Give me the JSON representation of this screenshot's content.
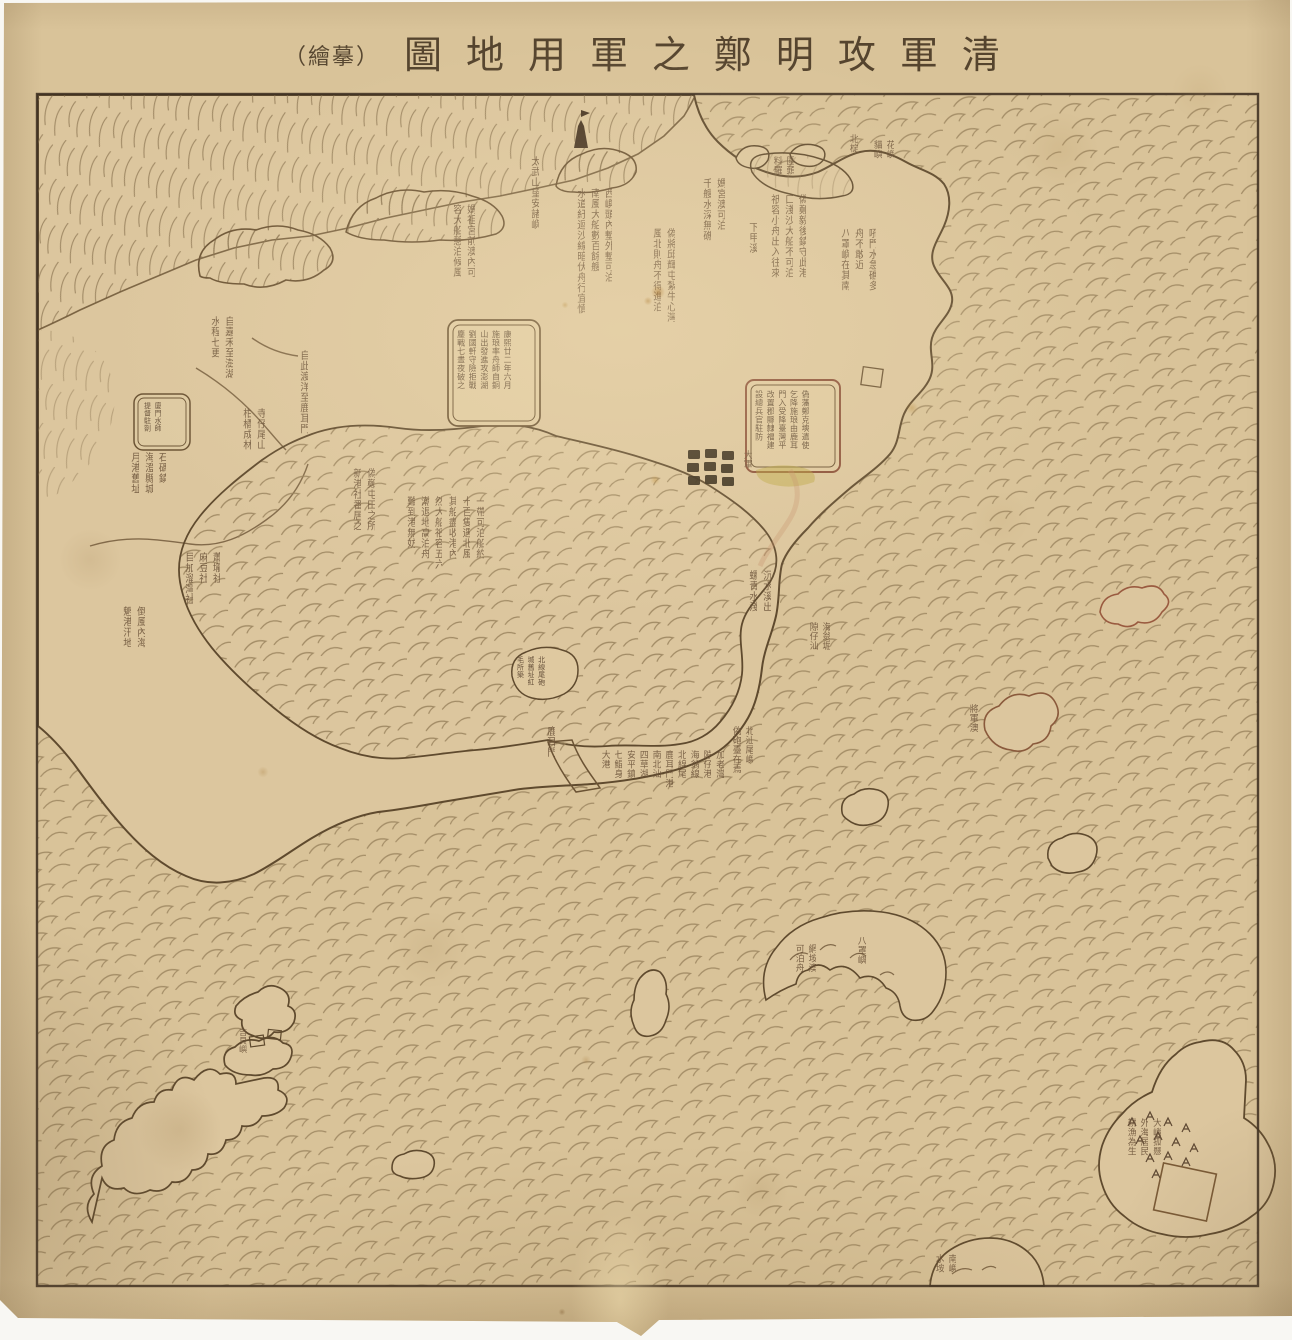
{
  "title": {
    "reading_rtl": "清軍攻明鄭之軍用地圖（摹繪）",
    "display_ltr": [
      "（繪摹）",
      "圖",
      "地",
      "用",
      "軍",
      "之",
      "鄭",
      "明",
      "攻",
      "軍",
      "清"
    ]
  },
  "palette": {
    "paper": "#d9c399",
    "land": "#dcc69e",
    "ink_outline": "#5f4a2e",
    "wave_ink": "#97805a",
    "text_ink": "#6a5138",
    "frame_ink": "#3f3122",
    "red_accent": "#9a5b40",
    "stain": "#a86f22",
    "unit_symbol": "#332818"
  },
  "transcription_fidelity": "approximate — handwritten brush annotations are largely illegible in source scan",
  "annotations": [
    {
      "name": "note-magong-anchorage",
      "x": 700,
      "y": 178,
      "h": 125,
      "fs": 10,
      "cols": [
        "媽宮澳可泊",
        "千艘水深無礁"
      ]
    },
    {
      "name": "note-xiajiaxi",
      "x": 746,
      "y": 222,
      "h": 64,
      "fs": 10,
      "cols": [
        "下甲溪"
      ]
    },
    {
      "name": "note-qiuhui-garrison",
      "x": 650,
      "y": 228,
      "h": 205,
      "fs": 10,
      "cols": [
        "偽將邱輝屯紮牛心灣",
        "風北則舟不得進泊"
      ]
    },
    {
      "name": "note-xiyu-passage",
      "x": 574,
      "y": 188,
      "h": 248,
      "fs": 10,
      "cols": [
        "西嶼頭內塹外塹可泊",
        "南風大船數百餘艘",
        "水道紆迴沙線暗伏舟行宜慎"
      ]
    },
    {
      "name": "note-taiwu-hills",
      "x": 528,
      "y": 156,
      "h": 140,
      "fs": 10,
      "cols": [
        "太武山望安諸嶼"
      ]
    },
    {
      "name": "note-mazu-harbor",
      "x": 450,
      "y": 204,
      "h": 192,
      "fs": 10,
      "cols": [
        "媽祖宮前澳內可",
        "容大船憩泊候風"
      ]
    },
    {
      "name": "note-houmen",
      "x": 838,
      "y": 228,
      "h": 196,
      "fs": 10,
      "cols": [
        "吼門水急礁多",
        "舟不敢近",
        "八罩嶼在其南"
      ]
    },
    {
      "name": "note-huayu",
      "x": 872,
      "y": 140,
      "h": 92,
      "fs": 9,
      "cols": [
        "花嶼",
        "貓嶼"
      ]
    },
    {
      "name": "note-east-coast",
      "x": 768,
      "y": 194,
      "h": 232,
      "fs": 10,
      "cols": [
        "偽鄭毅後鎮守此港",
        "口淺沙大船不可泊",
        "祇容小舟出入往來"
      ]
    },
    {
      "name": "note-water-route",
      "x": 208,
      "y": 316,
      "h": 92,
      "fs": 10,
      "cols": [
        "自嘉禾至澎湖",
        "水程七更"
      ]
    },
    {
      "name": "note-crossing",
      "x": 297,
      "y": 350,
      "h": 88,
      "fs": 10,
      "cols": [
        "自此渡洋至鹿耳門"
      ]
    },
    {
      "name": "note-temple-grove",
      "x": 240,
      "y": 408,
      "h": 122,
      "fs": 10,
      "cols": [
        "寺仔尾山",
        "柑橘成林"
      ]
    },
    {
      "name": "note-haicheng",
      "x": 128,
      "y": 452,
      "h": 128,
      "fs": 10,
      "cols": [
        "石碼鎮",
        "海澄縣城",
        "月港舊址"
      ]
    },
    {
      "name": "note-villages",
      "x": 182,
      "y": 552,
      "h": 152,
      "fs": 10,
      "cols": [
        "蕭壠社",
        "麻豆社",
        "目加溜灣社"
      ]
    },
    {
      "name": "note-daofeng-sea",
      "x": 120,
      "y": 606,
      "h": 116,
      "fs": 10,
      "cols": [
        "倒風內海",
        "魍港汛地"
      ]
    },
    {
      "name": "note-tuntian",
      "x": 350,
      "y": 468,
      "h": 182,
      "fs": 10,
      "cols": [
        "偽鄭屯田之所",
        "新港社番居之"
      ]
    },
    {
      "name": "note-anchorage-capacity",
      "x": 404,
      "y": 496,
      "h": 172,
      "fs": 10,
      "cols": [
        "一帶可泊船約",
        "十百隻遇北風",
        "其船盡收港內",
        "然大船祇容五六",
        "潮退地高泊舟",
        "難到港無妨"
      ]
    },
    {
      "name": "sandbar-port-names",
      "x": 600,
      "y": 750,
      "h": 80,
      "fs": 9,
      "cols": [
        "加老灣",
        "隙仔港",
        "海翁線",
        "北線尾",
        "鹿耳門港",
        "南北汕",
        "四草湖",
        "安平鎮",
        "七鯤身",
        "大港"
      ]
    },
    {
      "name": "note-beishanwei",
      "x": 731,
      "y": 726,
      "h": 94,
      "fs": 9,
      "cols": [
        "北汕尾嶼",
        "偽砲臺在焉"
      ]
    },
    {
      "name": "note-chenshuixi",
      "x": 746,
      "y": 570,
      "h": 90,
      "fs": 10,
      "cols": [
        "沉水溪出",
        "螺青水淺"
      ]
    },
    {
      "name": "note-haiwengku",
      "x": 808,
      "y": 622,
      "h": 72,
      "fs": 9,
      "cols": [
        "海翁堀",
        "隙仔汕"
      ]
    },
    {
      "name": "label-luermen",
      "x": 544,
      "y": 726,
      "h": 68,
      "fs": 10,
      "cols": [
        "鹿耳門"
      ]
    },
    {
      "name": "label-grand-army",
      "x": 742,
      "y": 450,
      "h": 36,
      "fs": 9,
      "cols": [
        "大軍"
      ]
    },
    {
      "name": "label-jiangjunao",
      "x": 968,
      "y": 704,
      "h": 58,
      "fs": 9,
      "cols": [
        "將軍澳"
      ]
    },
    {
      "name": "label-wangan",
      "x": 794,
      "y": 944,
      "h": 50,
      "fs": 9,
      "cols": [
        "網垵澳",
        "可泊舟"
      ]
    },
    {
      "name": "label-bazhao",
      "x": 856,
      "y": 936,
      "h": 42,
      "fs": 9,
      "cols": [
        "八罩嶼"
      ]
    },
    {
      "name": "note-dayu-island",
      "x": 1126,
      "y": 1118,
      "h": 88,
      "fs": 9,
      "cols": [
        "大嶼孤懸",
        "外海居民",
        "耕漁為生"
      ]
    },
    {
      "name": "label-nanyu",
      "x": 934,
      "y": 1254,
      "h": 32,
      "fs": 9,
      "cols": [
        "南嶼",
        "水垵"
      ]
    },
    {
      "name": "label-weitou",
      "x": 772,
      "y": 156,
      "h": 40,
      "fs": 9,
      "cols": [
        "圍頭",
        "料羅"
      ]
    },
    {
      "name": "label-beiding",
      "x": 848,
      "y": 134,
      "h": 32,
      "fs": 9,
      "cols": [
        "北椗"
      ]
    },
    {
      "name": "label-jibei",
      "x": 238,
      "y": 1028,
      "h": 42,
      "fs": 8,
      "cols": [
        "吉貝嶼"
      ]
    },
    {
      "name": "cartouche-shilang-text",
      "cart": true,
      "x": 456,
      "y": 330,
      "h": 90,
      "fs": 8,
      "cols": [
        "康熙廿二年六月",
        "施琅率舟師自銅",
        "山出發進攻澎湖",
        "劉國軒守險拒戰",
        "鏖戰七晝夜破之"
      ]
    },
    {
      "name": "cartouche-surrender-text",
      "cart": true,
      "x": 754,
      "y": 390,
      "h": 76,
      "fs": 8,
      "cols": [
        "偽藩鄭克塽遣使",
        "乞降施琅由鹿耳",
        "門入受降臺灣平",
        "改置郡縣隸福建",
        "設總兵官駐防"
      ]
    },
    {
      "name": "cartouche-seal-text",
      "cart": true,
      "x": 143,
      "y": 402,
      "h": 44,
      "fs": 7,
      "cols": [
        "廈門水師",
        "提督駐劄"
      ]
    },
    {
      "name": "enclosure-beixianwei-text",
      "cart": true,
      "x": 516,
      "y": 656,
      "h": 42,
      "fs": 7,
      "cols": [
        "北線尾砲",
        "城舊址紅",
        "毛所築"
      ]
    }
  ],
  "symbols": {
    "army_unit_grid": {
      "rows": 3,
      "cols": 3,
      "meaning": "clustered dark squares — army encampment",
      "label": "大軍"
    },
    "fort_rectangle_coast": "small rectangle fort on east coast",
    "fort_square_island": "tilted square fort on great outer island",
    "tower_flag": "dark tower with pennant on north hill coast",
    "houses_on_islet": "two small house rectangles on archipelago islet",
    "sprout_marks": "vegetation tufts on great outer island"
  },
  "geography": [
    "mainland-coast-with-mountain-range",
    "inner-lagoon-sea",
    "luermen-channel",
    "sandbar-barrier-strip",
    "north-bay-with-islets",
    "penghu-archipelago-southwest",
    "scattered-offshore-islands",
    "great-outer-island-southeast",
    "half-island-bottom-edge"
  ]
}
